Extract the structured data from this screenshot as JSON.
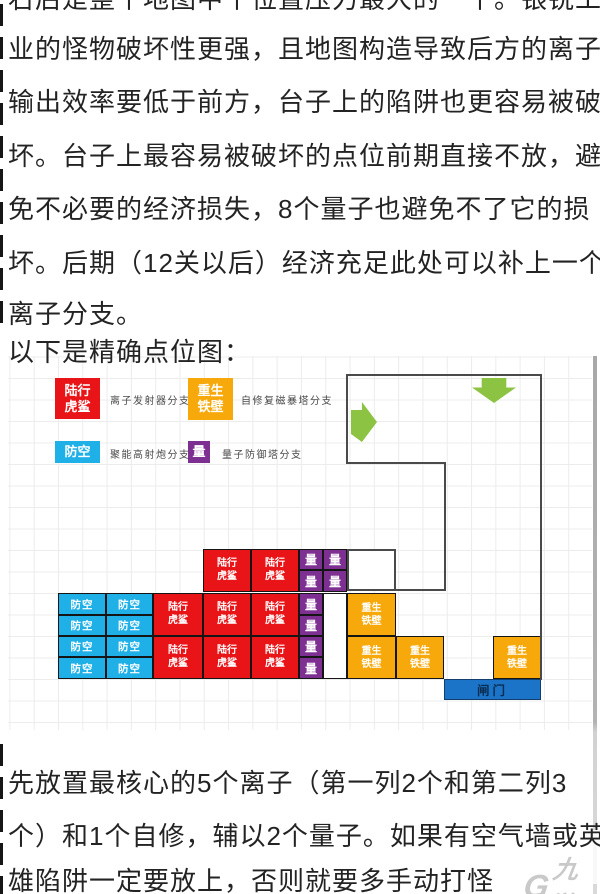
{
  "article": {
    "top_lines": [
      "右后是整个地图中个位置压力最大的一个。银锐工",
      "业的怪物破坏性更强，且地图构造导致后方的离子",
      "输出效率要低于前方，台子上的陷阱也更容易被破",
      "坏。台子上最容易被破坏的点位前期直接不放，避",
      "免不必要的经济损失，8个量子也避免不了它的损",
      "坏。后期（12关以后）经济充足此处可以补上一个",
      "离子分支。",
      "以下是精确点位图："
    ],
    "bottom_lines": [
      "先放置最核心的5个离子（第一列2个和第二列3",
      "个）和1个自修，辅以2个量子。如果有空气墙或英",
      "雄陷阱一定要放上，否则就要多手动打怪"
    ]
  },
  "legend": [
    {
      "tile_text": "陆行\n虎鲨",
      "label": "离子发射器分支",
      "color": "#e81418"
    },
    {
      "tile_text": "重生\n铁壁",
      "label": "自修复磁暴塔分支",
      "color": "#f7a90b"
    },
    {
      "tile_text": "防空",
      "label": "聚能高射炮分支",
      "color": "#1fb0e8"
    },
    {
      "tile_text": "量",
      "label": "量子防御塔分支",
      "color": "#7d2f92"
    }
  ],
  "map": {
    "tiles": [
      {
        "x": 203,
        "y": 549,
        "w": 48,
        "h": 43,
        "type": "red",
        "text": "陆行\n虎鲨"
      },
      {
        "x": 251,
        "y": 549,
        "w": 48,
        "h": 43,
        "type": "red",
        "text": "陆行\n虎鲨"
      },
      {
        "x": 299,
        "y": 549,
        "w": 24,
        "h": 21,
        "type": "purple",
        "text": "量"
      },
      {
        "x": 323,
        "y": 549,
        "w": 24,
        "h": 21,
        "type": "purple",
        "text": "量"
      },
      {
        "x": 299,
        "y": 570,
        "w": 24,
        "h": 22,
        "type": "purple",
        "text": "量"
      },
      {
        "x": 323,
        "y": 570,
        "w": 24,
        "h": 22,
        "type": "purple",
        "text": "量"
      },
      {
        "x": 347,
        "y": 549,
        "w": 49,
        "h": 42,
        "type": "whitebox",
        "text": ""
      },
      {
        "x": 58,
        "y": 593,
        "w": 48,
        "h": 22,
        "type": "blue",
        "text": "防空"
      },
      {
        "x": 106,
        "y": 593,
        "w": 47,
        "h": 22,
        "type": "blue",
        "text": "防空"
      },
      {
        "x": 58,
        "y": 615,
        "w": 48,
        "h": 21,
        "type": "blue",
        "text": "防空"
      },
      {
        "x": 106,
        "y": 615,
        "w": 47,
        "h": 21,
        "type": "blue",
        "text": "防空"
      },
      {
        "x": 58,
        "y": 636,
        "w": 48,
        "h": 21,
        "type": "blue",
        "text": "防空"
      },
      {
        "x": 106,
        "y": 636,
        "w": 47,
        "h": 21,
        "type": "blue",
        "text": "防空"
      },
      {
        "x": 58,
        "y": 657,
        "w": 48,
        "h": 22,
        "type": "blue",
        "text": "防空"
      },
      {
        "x": 106,
        "y": 657,
        "w": 47,
        "h": 22,
        "type": "blue",
        "text": "防空"
      },
      {
        "x": 153,
        "y": 593,
        "w": 50,
        "h": 43,
        "type": "red",
        "text": "陆行\n虎鲨"
      },
      {
        "x": 203,
        "y": 593,
        "w": 48,
        "h": 43,
        "type": "red",
        "text": "陆行\n虎鲨"
      },
      {
        "x": 251,
        "y": 593,
        "w": 48,
        "h": 43,
        "type": "red",
        "text": "陆行\n虎鲨"
      },
      {
        "x": 153,
        "y": 636,
        "w": 50,
        "h": 43,
        "type": "red",
        "text": "陆行\n虎鲨"
      },
      {
        "x": 203,
        "y": 636,
        "w": 48,
        "h": 43,
        "type": "red",
        "text": "陆行\n虎鲨"
      },
      {
        "x": 251,
        "y": 636,
        "w": 48,
        "h": 43,
        "type": "red",
        "text": "陆行\n虎鲨"
      },
      {
        "x": 299,
        "y": 593,
        "w": 24,
        "h": 22,
        "type": "purple",
        "text": "量"
      },
      {
        "x": 299,
        "y": 615,
        "w": 24,
        "h": 21,
        "type": "purple",
        "text": "量"
      },
      {
        "x": 299,
        "y": 636,
        "w": 24,
        "h": 21,
        "type": "purple",
        "text": "量"
      },
      {
        "x": 299,
        "y": 657,
        "w": 24,
        "h": 22,
        "type": "purple",
        "text": "量"
      },
      {
        "x": 323,
        "y": 593,
        "w": 24,
        "h": 86,
        "type": "white",
        "text": ""
      },
      {
        "x": 347,
        "y": 593,
        "w": 49,
        "h": 43,
        "type": "orange",
        "text": "重生\n铁壁"
      },
      {
        "x": 347,
        "y": 636,
        "w": 49,
        "h": 43,
        "type": "orange",
        "text": "重生\n铁壁"
      },
      {
        "x": 396,
        "y": 636,
        "w": 48,
        "h": 43,
        "type": "orange",
        "text": "重生\n铁壁"
      },
      {
        "x": 493,
        "y": 636,
        "w": 48,
        "h": 43,
        "type": "orange",
        "text": "重生\n铁壁"
      },
      {
        "x": 444,
        "y": 679,
        "w": 97,
        "h": 21,
        "type": "gate",
        "text": "闸门"
      }
    ],
    "outline": [
      [
        347,
        374,
        195,
        2
      ],
      [
        540,
        374,
        2,
        306
      ],
      [
        346,
        374,
        2,
        90
      ],
      [
        346,
        462,
        100,
        2
      ],
      [
        444,
        462,
        2,
        129
      ],
      [
        396,
        589,
        50,
        2
      ]
    ],
    "arrows": [
      {
        "dir": "right",
        "x": 351,
        "y": 402,
        "w": 26,
        "h": 40
      },
      {
        "dir": "down",
        "x": 472,
        "y": 378,
        "w": 44,
        "h": 25
      }
    ]
  },
  "watermark": {
    "glyph": "G",
    "text": "九游"
  },
  "colors": {
    "tile_red": "#e81418",
    "tile_blue": "#1fb0e8",
    "tile_orange": "#f7a90b",
    "tile_purple": "#7d2f92",
    "gate_blue": "#1b74c8",
    "gate_text": "#0a2c50",
    "arrow_green": "#8cc342",
    "outline_gray": "#4a4a4a",
    "grid_line": "#ececec",
    "body_text": "#232323"
  }
}
